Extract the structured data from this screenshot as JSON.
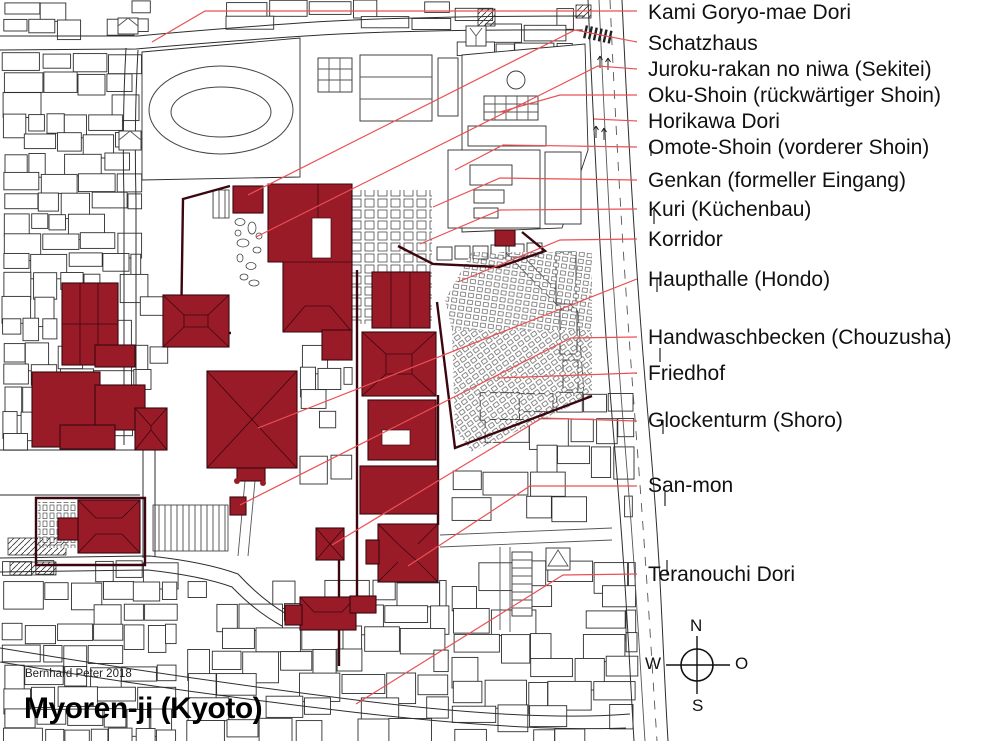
{
  "title": "Myoren-ji (Kyoto)",
  "attribution": "Bernhard Peter 2018",
  "compass": {
    "north": "N",
    "south": "S",
    "west": "W",
    "east": "O"
  },
  "labels": [
    {
      "text": "Kami Goryo-mae Dori"
    },
    {
      "text": "Schatzhaus"
    },
    {
      "text": "Juroku-rakan no niwa (Sekitei)"
    },
    {
      "text": "Oku-Shoin (rückwärtiger Shoin)"
    },
    {
      "text": "Horikawa Dori"
    },
    {
      "text": "Omote-Shoin (vorderer Shoin)"
    },
    {
      "text": "Genkan (formeller Eingang)"
    },
    {
      "text": "Kuri (Küchenbau)"
    },
    {
      "text": "Korridor"
    },
    {
      "text": "Haupthalle (Hondo)"
    },
    {
      "text": "Handwaschbecken (Chouzusha)"
    },
    {
      "text": "Friedhof"
    },
    {
      "text": "Glockenturm (Shoro)"
    },
    {
      "text": "San-mon"
    },
    {
      "text": "Teranouchi Dori"
    }
  ],
  "colors": {
    "building_red": "#9a1b28",
    "wall_dark_red": "#3a070f",
    "leader_red": "#ea5054",
    "line_black": "#2d2d2d"
  }
}
